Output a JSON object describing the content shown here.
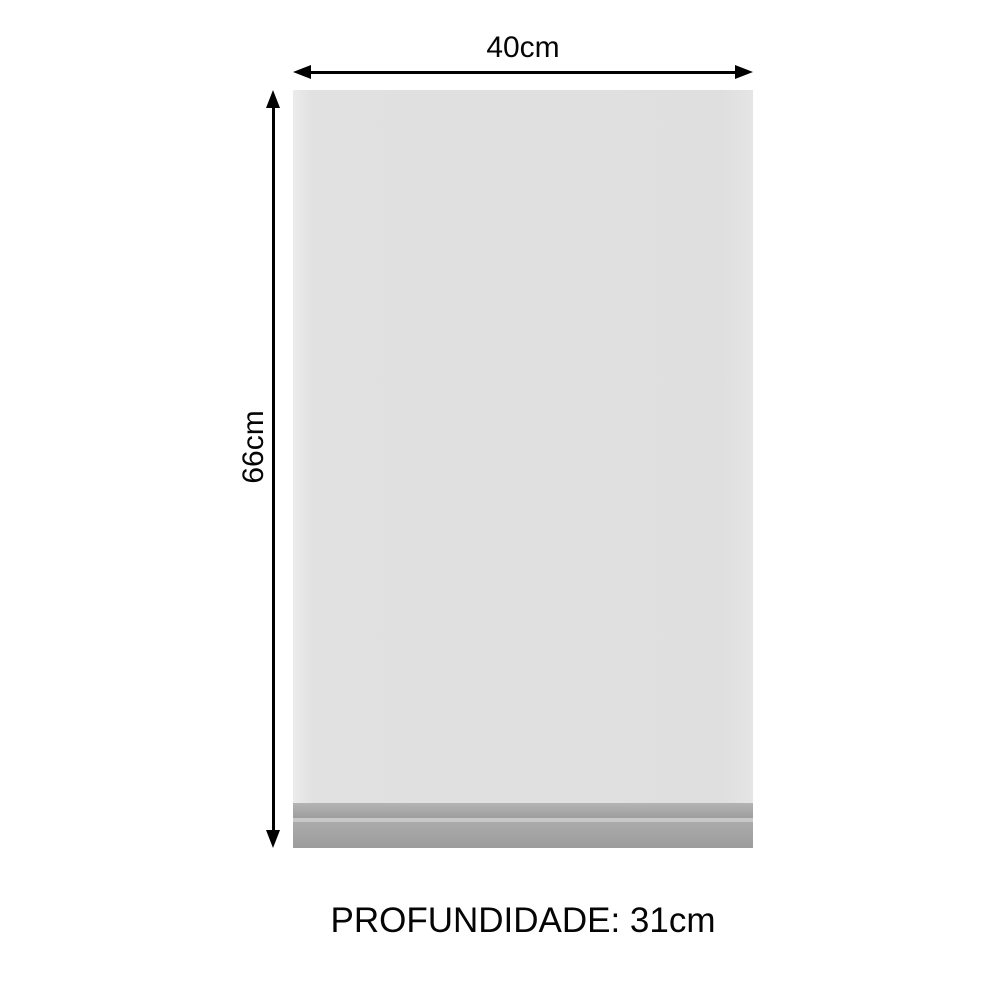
{
  "diagram": {
    "title": "cabinet-door-dimension-diagram",
    "width_label": "40cm",
    "height_label": "66cm",
    "depth_label": "PROFUNDIDADE: 31cm",
    "dimensions": {
      "width_cm": 40,
      "height_cm": 66,
      "depth_cm": 31
    },
    "colors": {
      "background": "#ffffff",
      "panel": "#e0e0e0",
      "panel_edge_highlight": "#ebebeb",
      "plinth_top_band": "#a9a9a9",
      "plinth_highlight_line": "#c8c8c8",
      "plinth_bottom_band": "#a3a3a3",
      "arrow": "#000000",
      "text": "#050505"
    },
    "icons": {
      "horizontal_arrow": "double-headed-arrow-horizontal",
      "vertical_arrow": "double-headed-arrow-vertical"
    }
  }
}
